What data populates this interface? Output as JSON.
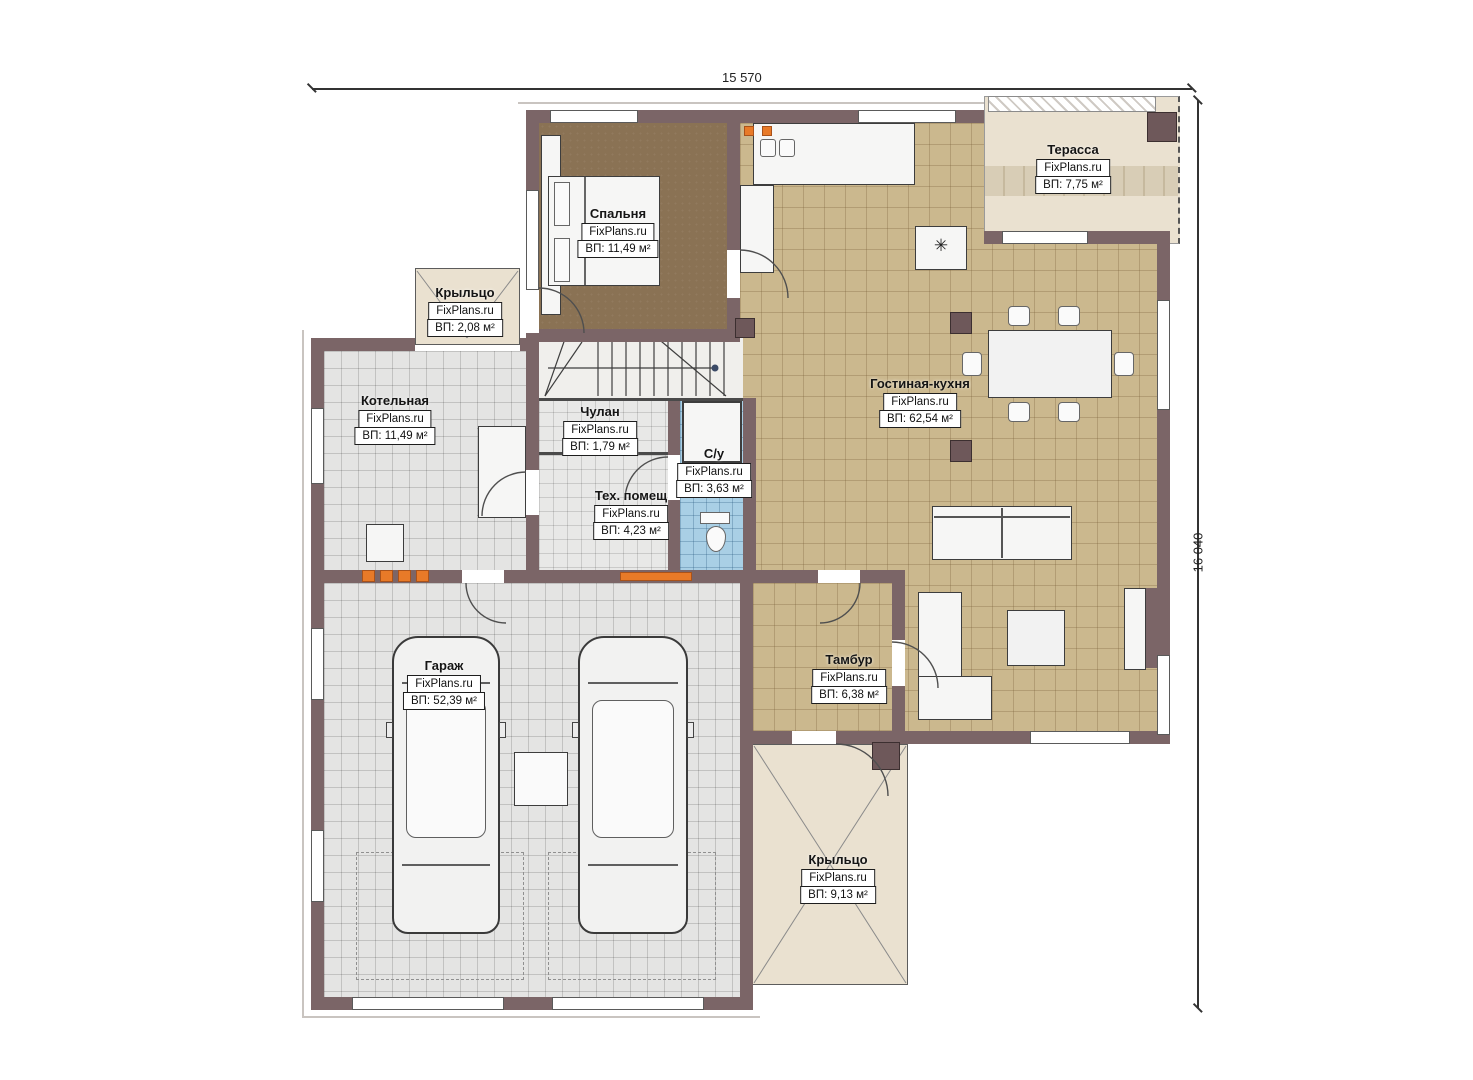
{
  "plan": {
    "dimensions": {
      "width_label": "15 570",
      "height_label": "16 040"
    },
    "rooms": {
      "bedroom": {
        "name": "Спальня",
        "watermark": "FixPlans.ru",
        "area": "ВП: 11,49 м²"
      },
      "terrace": {
        "name": "Терасса",
        "watermark": "FixPlans.ru",
        "area": "ВП: 7,75 м²"
      },
      "porch_left": {
        "name": "Крыльцо",
        "watermark": "FixPlans.ru",
        "area": "ВП: 2,08 м²"
      },
      "boiler": {
        "name": "Котельная",
        "watermark": "FixPlans.ru",
        "area": "ВП: 11,49 м²"
      },
      "closet": {
        "name": "Чулан",
        "watermark": "FixPlans.ru",
        "area": "ВП: 1,79 м²"
      },
      "living_kitchen": {
        "name": "Гостиная-кухня",
        "watermark": "FixPlans.ru",
        "area": "ВП: 62,54 м²"
      },
      "bathroom": {
        "name": "С/у",
        "watermark": "FixPlans.ru",
        "area": "ВП: 3,63 м²"
      },
      "tech": {
        "name": "Тех. помещ",
        "watermark": "FixPlans.ru",
        "area": "ВП: 4,23 м²"
      },
      "garage": {
        "name": "Гараж",
        "watermark": "FixPlans.ru",
        "area": "ВП: 52,39 м²"
      },
      "vestibule": {
        "name": "Тамбур",
        "watermark": "FixPlans.ru",
        "area": "ВП: 6,38 м²"
      },
      "porch_bottom": {
        "name": "Крыльцо",
        "watermark": "FixPlans.ru",
        "area": "ВП: 9,13 м²"
      }
    },
    "icons": {
      "snowflake": "✳"
    },
    "colors": {
      "wall": "#7b6567",
      "radiator": "#e87a28"
    }
  }
}
